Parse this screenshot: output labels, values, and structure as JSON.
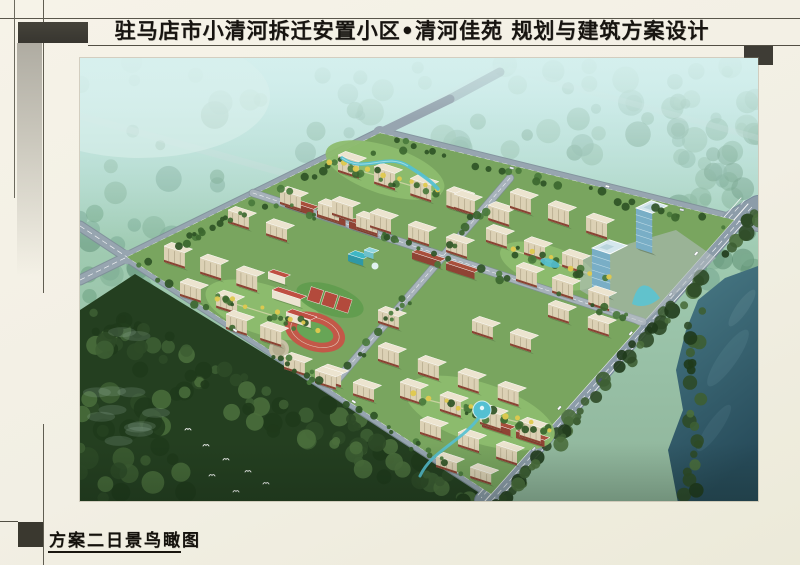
{
  "header": {
    "title": "驻马店市小清河拆迁安置小区•清河佳苑 规划与建筑方案设计"
  },
  "footer": {
    "caption": "方案二日景鸟瞰图"
  },
  "rendering": {
    "type": "architectural-aerial-rendering",
    "scene": "daytime bird's-eye view of a resettlement residential district",
    "features": [
      "misty-forest-backdrop",
      "perimeter-roads",
      "residential-towers",
      "school-running-track",
      "basketball-courts",
      "kindergarten",
      "office-towers",
      "commercial-strips",
      "central-water-features",
      "lake",
      "foreground-forest",
      "egrets",
      "vehicles"
    ],
    "colors": {
      "ink": "#171410",
      "accent_block": "#3e3c35",
      "haze": "#d6f0ee",
      "mist_forest_1": "#6fa18c",
      "mist_forest_2": "#629878",
      "mist_forest_3": "#7bab90",
      "mist_forest_4": "#578a6e",
      "forest_dark": "#243f20",
      "forest_blob_1": "#2d4a27",
      "forest_blob_2": "#3d5e33",
      "forest_blob_3": "#1f3a1b",
      "forest_blob_4": "#4a6e3c",
      "lake_top": "#4a7c88",
      "lake_deep": "#274b5a",
      "road": "#97a5b0",
      "road_casing": "#7e8d99",
      "avenue": "#8c9ca9",
      "lane": "#ffffff",
      "site_green": "#79a55f",
      "courtyard": "#8dbc6e",
      "path": "#e8dfbc",
      "bldg_roof": "#ece4cf",
      "bldg_front": "#dcd1b5",
      "bldg_side": "#c9bd9f",
      "bldg_base": "#8a4434",
      "bldg_window": "#a5997b",
      "commercial_roof": "#a94f3c",
      "commercial_front": "#8f4334",
      "commercial_side": "#7c3a2e",
      "school_roof": "#bf4f42",
      "school_front": "#ece4d2",
      "school_side": "#d8cfba",
      "track": "#c35848",
      "track_infield": "#67a556",
      "court": "#b34a3c",
      "kindergarten_1": "#3fb6c4",
      "kindergarten_2": "#8fd6de",
      "office_glass": "#79aec6",
      "office_glass_side": "#5f93ab",
      "office_roof": "#d5e7ed",
      "canopy": "#57c4d6",
      "water_feature": "#54c0d2",
      "tree_dark": "#3c672f",
      "tree_mid": "#4a7a3c",
      "tree_deep": "#2f5426",
      "tree_yellow": "#dfc94e",
      "plaza": "#b6bfc3",
      "bird": "#ffffff"
    }
  }
}
